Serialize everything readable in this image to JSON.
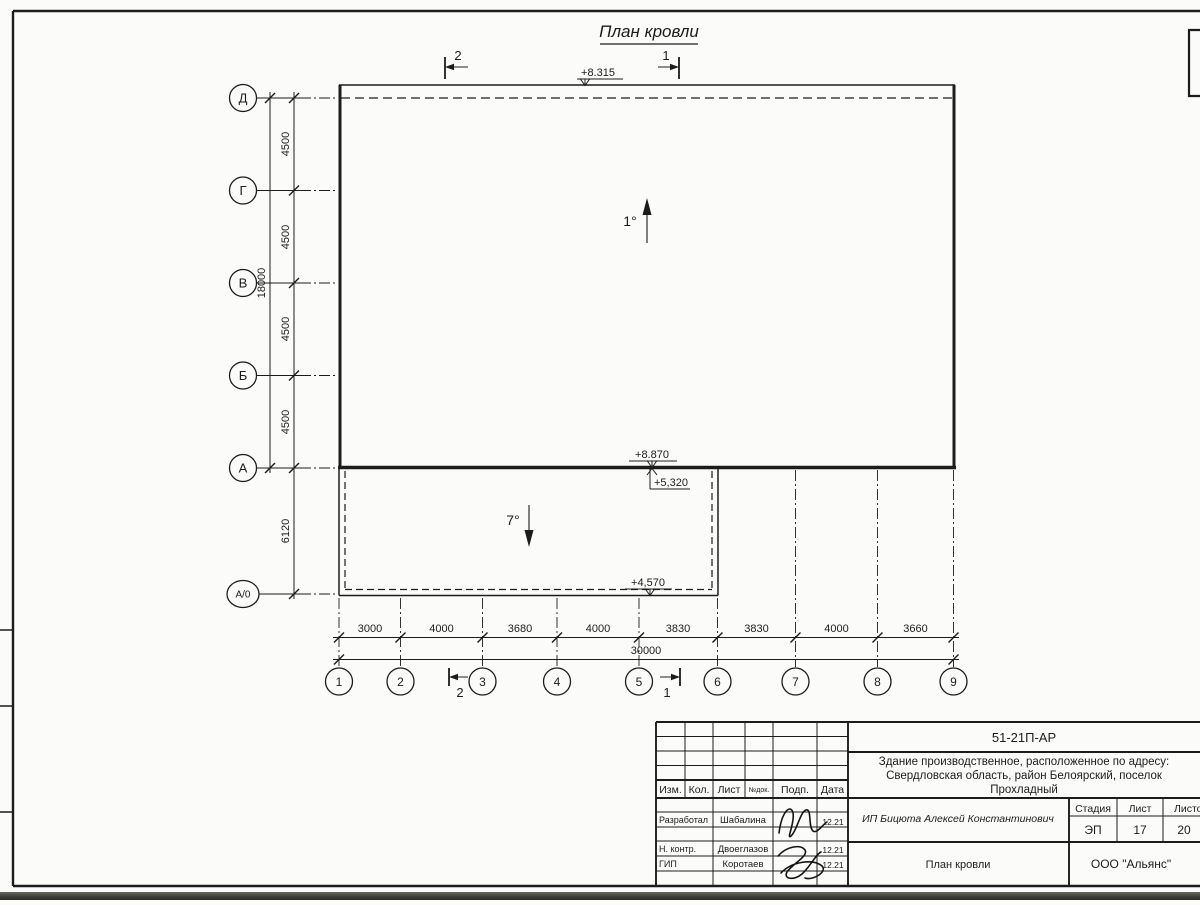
{
  "drawing": {
    "title": "План кровли",
    "elevation_top": "+8.315",
    "elevation_wall_upper": "+8.870",
    "elevation_wall_lower": "+5,320",
    "elevation_annex": "+4,570",
    "slope_main": "1°",
    "slope_annex": "7°",
    "section_top_left": "2",
    "section_top_right": "1",
    "section_bottom_left": "2",
    "section_bottom_right": "1",
    "axes_vertical": [
      "Д",
      "Г",
      "В",
      "Б",
      "А",
      "А/0"
    ],
    "axes_horizontal": [
      "1",
      "2",
      "3",
      "4",
      "5",
      "6",
      "7",
      "8",
      "9"
    ],
    "dims_vertical": [
      "4500",
      "4500",
      "4500",
      "4500"
    ],
    "dim_annex_vertical": "6120",
    "dim_vertical_total": "18000",
    "dims_horizontal": [
      "3000",
      "4000",
      "3680",
      "4000",
      "3830",
      "3830",
      "4000",
      "3660"
    ],
    "dim_horizontal_total": "30000"
  },
  "title_block": {
    "doc_number": "51-21П-АР",
    "description_line1": "Здание производственное, расположенное по адресу:",
    "description_line2": "Свердловская область, район Белоярский, поселок",
    "description_line3": "Прохладный",
    "header_cols": [
      "Изм.",
      "Кол.",
      "Лист",
      "№док.",
      "Подп.",
      "Дата"
    ],
    "rows": [
      {
        "role": "Разработал",
        "name": "Шабалина",
        "date": "12.21"
      },
      {
        "role": "Н. контр.",
        "name": "Двоеглазов",
        "date": "12.21"
      },
      {
        "role": "ГИП",
        "name": "Коротаев",
        "date": "12.21"
      }
    ],
    "client": "ИП Бицюта Алексей Константинович",
    "sheet_title": "План кровли",
    "stage_label": "Стадия",
    "sheet_label": "Лист",
    "sheets_label": "Листов",
    "stage": "ЭП",
    "sheet_no": "17",
    "sheets_total": "20",
    "company": "ООО \"Альянс\""
  }
}
